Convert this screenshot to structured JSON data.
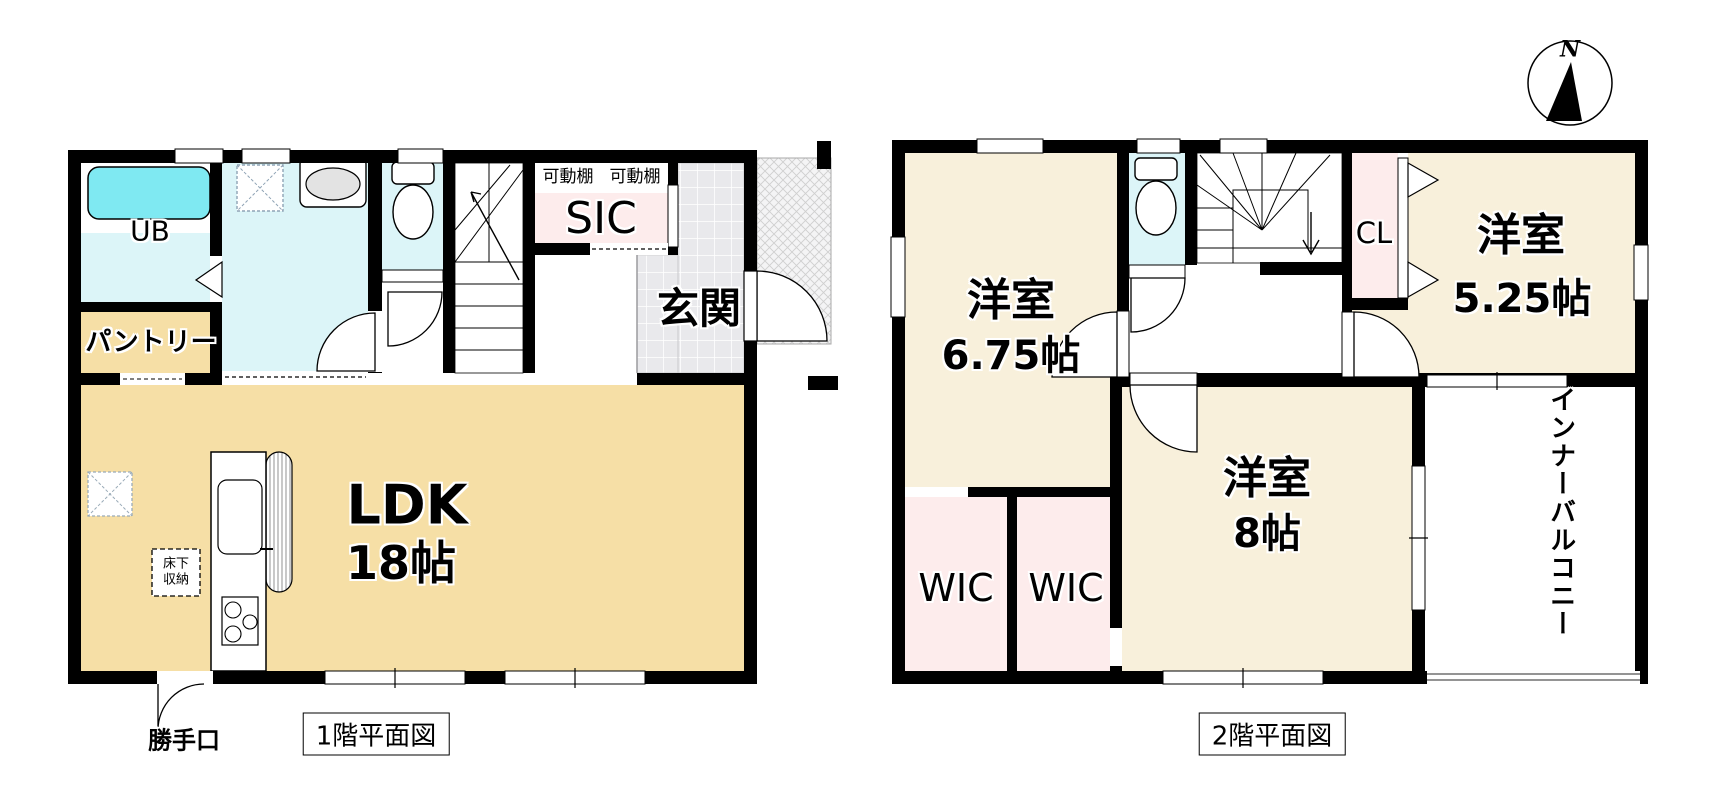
{
  "compass": {
    "north": "N"
  },
  "floor1": {
    "caption": "1階平面図",
    "rooms": {
      "ldk": {
        "name": "LDK",
        "size": "18帖"
      },
      "bath": {
        "label": "UB"
      },
      "pantry": {
        "label": "パントリー"
      },
      "sic": {
        "label": "SIC"
      },
      "genkan": {
        "label": "玄関"
      },
      "shelf_left": {
        "label": "可動棚"
      },
      "shelf_right": {
        "label": "可動棚"
      },
      "underfloor": {
        "line1": "床下",
        "line2": "収納"
      },
      "backdoor": {
        "label": "勝手口"
      }
    }
  },
  "floor2": {
    "caption": "2階平面図",
    "rooms": {
      "west_room": {
        "name": "洋室",
        "size": "6.75帖"
      },
      "east_room": {
        "name": "洋室",
        "size": "5.25帖"
      },
      "south_room": {
        "name": "洋室",
        "size": "8帖"
      },
      "wic_left": {
        "label": "WIC"
      },
      "wic_right": {
        "label": "WIC"
      },
      "cl": {
        "label": "CL"
      },
      "balcony": {
        "label": "インナーバルコニー"
      }
    }
  },
  "colors": {
    "wall": "#000000",
    "ldk_floor": "#f6dfa6",
    "room_floor_2f": "#f8f0db",
    "wet_area": "#dcf5f8",
    "bathtub": "#7fe9f2",
    "closet_pink": "#fdecec",
    "shelf_tan": "#cfc3ae",
    "tile_gray": "#e9e9ec"
  }
}
